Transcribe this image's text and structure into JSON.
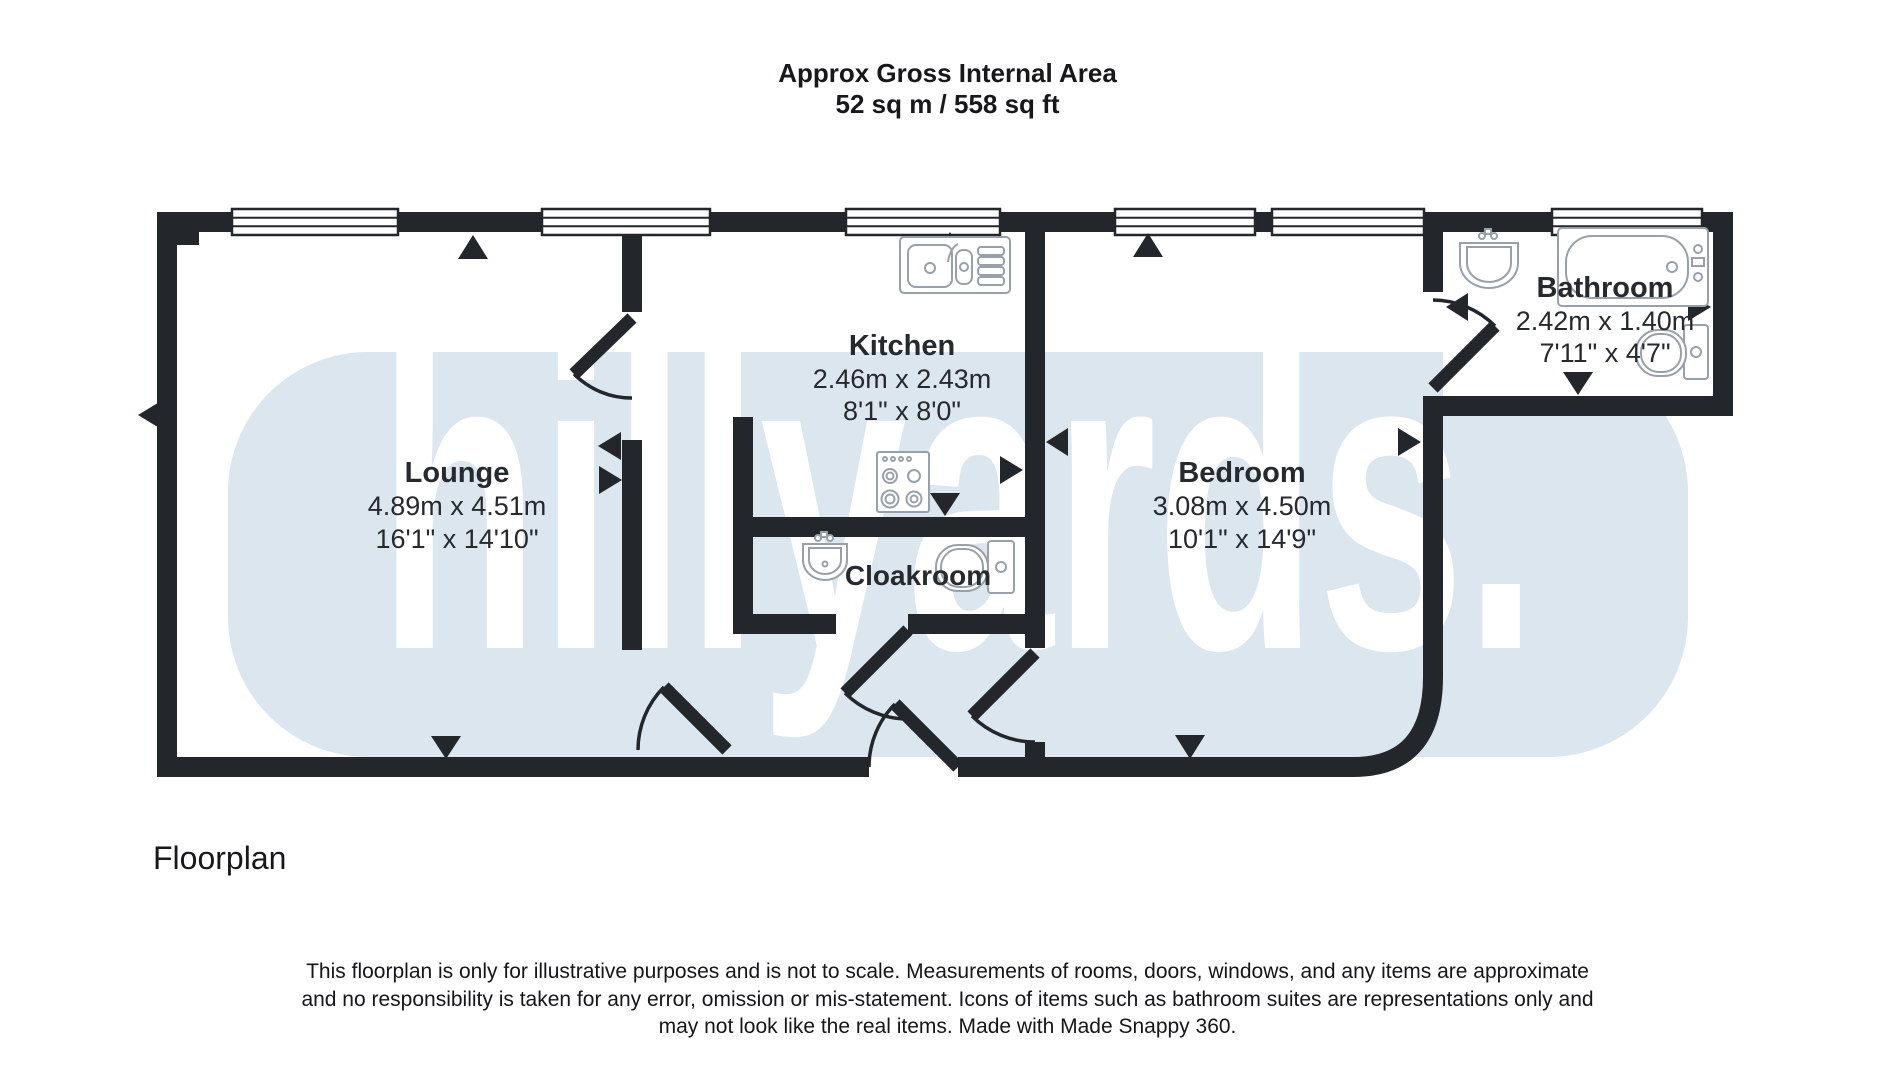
{
  "header": {
    "line1": "Approx Gross Internal Area",
    "line2": "52 sq m / 558 sq ft"
  },
  "watermark": {
    "text": "hillyards."
  },
  "colors": {
    "wall": "#23262b",
    "band": "#dce6ef",
    "watermark_text": "#ffffff",
    "fixture_stroke": "#98a0aa",
    "label_text": "#26292e"
  },
  "rooms": {
    "lounge": {
      "name": "Lounge",
      "metric": "4.89m x 4.51m",
      "imperial": "16'1\" x 14'10\""
    },
    "kitchen": {
      "name": "Kitchen",
      "metric": "2.46m x 2.43m",
      "imperial": "8'1\" x 8'0\""
    },
    "cloakroom": {
      "name": "Cloakroom"
    },
    "bedroom": {
      "name": "Bedroom",
      "metric": "3.08m x 4.50m",
      "imperial": "10'1\" x 14'9\""
    },
    "bathroom": {
      "name": "Bathroom",
      "metric": "2.42m x 1.40m",
      "imperial": "7'11\" x 4'7\""
    }
  },
  "footer": {
    "label": "Floorplan"
  },
  "disclaimer": [
    "This floorplan is only for illustrative purposes and is not to scale. Measurements of rooms, doors, windows, and any items are approximate",
    "and no responsibility is taken for any error, omission or mis-statement. Icons of items such as bathroom suites are representations only and",
    "may not look like the real items. Made with Made Snappy 360."
  ]
}
